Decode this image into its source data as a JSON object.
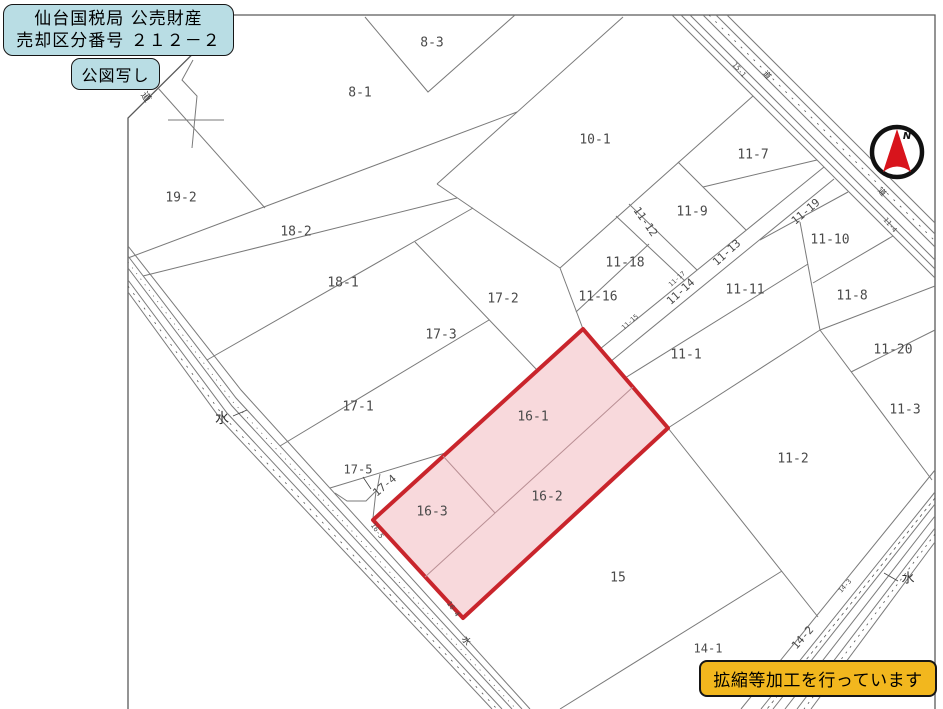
{
  "header": {
    "title_line1": "仙台国税局 公売財産",
    "title_line2": "売却区分番号 ２１２－２",
    "subtitle": "公図写し"
  },
  "footer": {
    "note": "拡縮等加工を行っています"
  },
  "colors": {
    "box_blue": "#b9dde4",
    "box_yellow": "#f2b71e",
    "highlight_fill": "#f8d9dc",
    "highlight_border": "#c9252c",
    "highlight_inner_line": "#b98f94",
    "line": "#7a7a7a",
    "frame": "#5a5a5a",
    "compass_red": "#d8141c"
  },
  "compass": {
    "label": "N"
  },
  "map": {
    "highlighted_parcels": [
      "16-1",
      "16-2",
      "16-3"
    ],
    "labels": [
      {
        "text": "8-3",
        "x": 432,
        "y": 43,
        "kind": "parcel",
        "size": 13
      },
      {
        "text": "8-1",
        "x": 360,
        "y": 93,
        "kind": "parcel",
        "size": 13
      },
      {
        "text": "10-1",
        "x": 595,
        "y": 140,
        "kind": "parcel",
        "size": 13
      },
      {
        "text": "11-7",
        "x": 753,
        "y": 155,
        "kind": "parcel",
        "size": 13
      },
      {
        "text": "19-2",
        "x": 181,
        "y": 198,
        "kind": "parcel",
        "size": 13
      },
      {
        "text": "11-9",
        "x": 692,
        "y": 212,
        "kind": "parcel",
        "size": 13
      },
      {
        "text": "18-2",
        "x": 296,
        "y": 232,
        "kind": "parcel",
        "size": 13
      },
      {
        "text": "11-10",
        "x": 830,
        "y": 240,
        "kind": "parcel",
        "size": 13
      },
      {
        "text": "11-18",
        "x": 625,
        "y": 263,
        "kind": "parcel",
        "size": 13
      },
      {
        "text": "18-1",
        "x": 343,
        "y": 283,
        "kind": "parcel",
        "size": 13
      },
      {
        "text": "11-11",
        "x": 745,
        "y": 290,
        "kind": "parcel",
        "size": 13
      },
      {
        "text": "11-8",
        "x": 852,
        "y": 296,
        "kind": "parcel",
        "size": 13
      },
      {
        "text": "11-16",
        "x": 598,
        "y": 297,
        "kind": "parcel",
        "size": 13
      },
      {
        "text": "17-2",
        "x": 503,
        "y": 299,
        "kind": "parcel",
        "size": 13
      },
      {
        "text": "17-3",
        "x": 441,
        "y": 335,
        "kind": "parcel",
        "size": 13
      },
      {
        "text": "11-20",
        "x": 893,
        "y": 350,
        "kind": "parcel",
        "size": 13
      },
      {
        "text": "11-1",
        "x": 686,
        "y": 355,
        "kind": "parcel",
        "size": 13
      },
      {
        "text": "17-1",
        "x": 358,
        "y": 407,
        "kind": "parcel",
        "size": 13
      },
      {
        "text": "11-3",
        "x": 905,
        "y": 410,
        "kind": "parcel",
        "size": 13
      },
      {
        "text": "16-1",
        "x": 533,
        "y": 417,
        "kind": "parcel",
        "size": 13
      },
      {
        "text": "11-2",
        "x": 793,
        "y": 459,
        "kind": "parcel",
        "size": 13
      },
      {
        "text": "17-5",
        "x": 358,
        "y": 470,
        "kind": "parcel",
        "size": 12
      },
      {
        "text": "16-2",
        "x": 547,
        "y": 497,
        "kind": "parcel",
        "size": 13
      },
      {
        "text": "16-3",
        "x": 432,
        "y": 512,
        "kind": "parcel",
        "size": 13
      },
      {
        "text": "15",
        "x": 618,
        "y": 578,
        "kind": "parcel",
        "size": 13
      },
      {
        "text": "14-1",
        "x": 708,
        "y": 649,
        "kind": "parcel",
        "size": 12
      },
      {
        "text": "11-12",
        "x": 645,
        "y": 222,
        "rot": 55,
        "kind": "parcel",
        "size": 11
      },
      {
        "text": "11-13",
        "x": 727,
        "y": 253,
        "rot": -42,
        "kind": "parcel",
        "size": 11
      },
      {
        "text": "11-14",
        "x": 681,
        "y": 292,
        "rot": -42,
        "kind": "parcel",
        "size": 11
      },
      {
        "text": "11-19",
        "x": 806,
        "y": 212,
        "rot": -40,
        "kind": "parcel",
        "size": 11
      },
      {
        "text": "17-4",
        "x": 385,
        "y": 486,
        "rot": -40,
        "kind": "parcel",
        "size": 11
      },
      {
        "text": "14-2",
        "x": 803,
        "y": 638,
        "rot": -48,
        "kind": "parcel",
        "size": 11
      },
      {
        "text": "水",
        "x": 222,
        "y": 419,
        "kind": "water",
        "size": 14
      },
      {
        "text": "水",
        "x": 908,
        "y": 579,
        "kind": "water",
        "size": 13
      },
      {
        "text": "水",
        "x": 466,
        "y": 641,
        "rot": 55,
        "kind": "water",
        "size": 9
      },
      {
        "text": "道",
        "x": 146,
        "y": 97,
        "rot": 55,
        "kind": "road",
        "size": 10
      },
      {
        "text": "道",
        "x": 767,
        "y": 75,
        "rot": 50,
        "kind": "road",
        "size": 8
      },
      {
        "text": "道",
        "x": 882,
        "y": 192,
        "rot": 50,
        "kind": "road",
        "size": 8
      },
      {
        "text": "15-1",
        "x": 739,
        "y": 70,
        "rot": 50,
        "kind": "parcel",
        "size": 7
      },
      {
        "text": "11-4",
        "x": 890,
        "y": 225,
        "rot": 50,
        "kind": "parcel",
        "size": 7
      },
      {
        "text": "11-15",
        "x": 630,
        "y": 322,
        "rot": -42,
        "kind": "parcel",
        "size": 6.5
      },
      {
        "text": "11-17",
        "x": 677,
        "y": 279,
        "rot": -42,
        "kind": "parcel",
        "size": 6.5
      },
      {
        "text": "16-5",
        "x": 377,
        "y": 531,
        "rot": 55,
        "kind": "parcel",
        "size": 7
      },
      {
        "text": "16-4",
        "x": 453,
        "y": 609,
        "rot": 55,
        "kind": "parcel",
        "size": 7
      },
      {
        "text": "14-3",
        "x": 845,
        "y": 586,
        "rot": -48,
        "kind": "parcel",
        "size": 6.5
      },
      {
        "text": "N",
        "x": 907,
        "y": 136,
        "kind": "compass",
        "size": 10
      }
    ]
  }
}
